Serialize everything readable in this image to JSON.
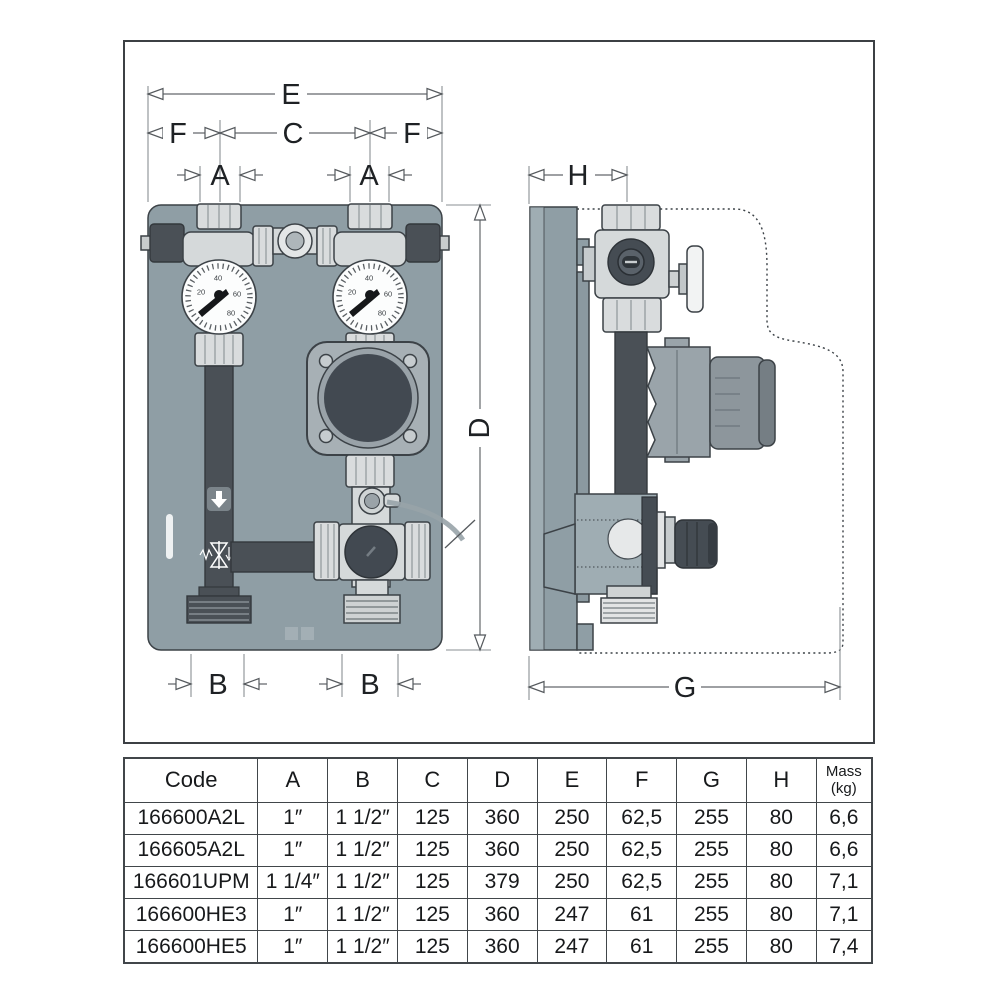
{
  "figure": {
    "dimension_labels": {
      "e": "E",
      "f": "F",
      "c": "C",
      "a": "A",
      "h": "H",
      "d": "D",
      "b": "B",
      "g": "G"
    },
    "gauge_dial_numbers": [
      "20",
      "40",
      "60",
      "80"
    ],
    "colors": {
      "panel": "#8f9ea5",
      "dark_pipe": "#4a5056",
      "metal_light": "#d9dcdd",
      "outline": "#3c4247",
      "dimension_line": "#63686c"
    }
  },
  "table": {
    "code_header": "Code",
    "dim_headers": [
      "A",
      "B",
      "C",
      "D",
      "E",
      "F",
      "G",
      "H"
    ],
    "mass_header_line1": "Mass",
    "mass_header_line2": "(kg)",
    "rows": [
      {
        "code": "166600A2L",
        "a": "1″",
        "b": "1 1/2″",
        "c": "125",
        "d": "360",
        "e": "250",
        "f": "62,5",
        "g": "255",
        "h": "80",
        "mass": "6,6"
      },
      {
        "code": "166605A2L",
        "a": "1″",
        "b": "1 1/2″",
        "c": "125",
        "d": "360",
        "e": "250",
        "f": "62,5",
        "g": "255",
        "h": "80",
        "mass": "6,6"
      },
      {
        "code": "166601UPM",
        "a": "1 1/4″",
        "b": "1 1/2″",
        "c": "125",
        "d": "379",
        "e": "250",
        "f": "62,5",
        "g": "255",
        "h": "80",
        "mass": "7,1"
      },
      {
        "code": "166600HE3",
        "a": "1″",
        "b": "1 1/2″",
        "c": "125",
        "d": "360",
        "e": "247",
        "f": "61",
        "g": "255",
        "h": "80",
        "mass": "7,1"
      },
      {
        "code": "166600HE5",
        "a": "1″",
        "b": "1 1/2″",
        "c": "125",
        "d": "360",
        "e": "247",
        "f": "61",
        "g": "255",
        "h": "80",
        "mass": "7,4"
      }
    ]
  }
}
